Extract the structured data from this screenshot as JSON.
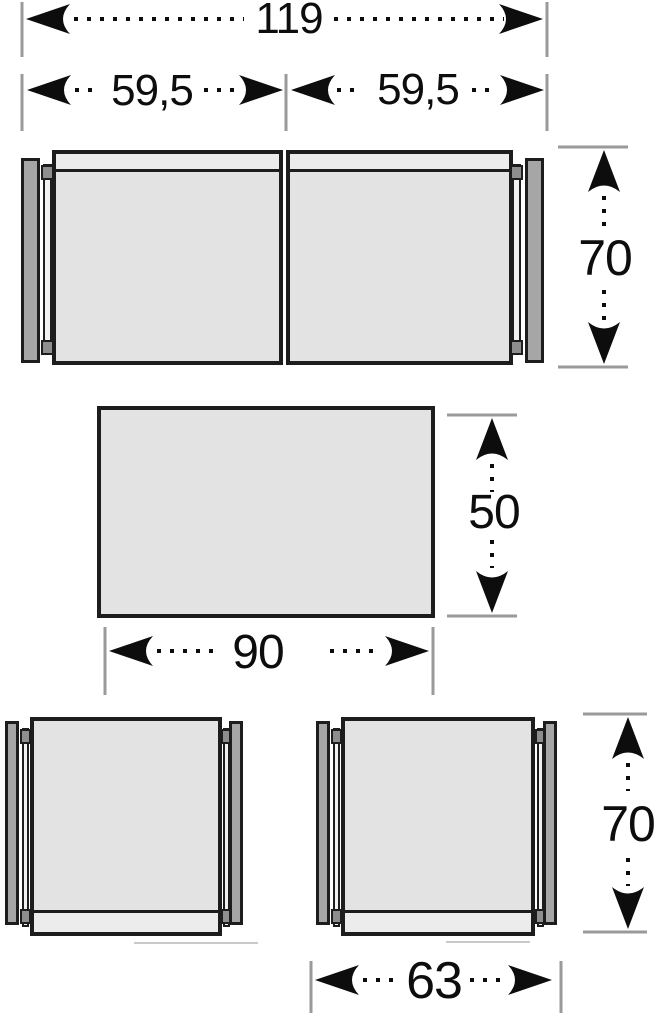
{
  "labels": {
    "sofa_total_width": "119",
    "sofa_left_seat_width": "59,5",
    "sofa_right_seat_width": "59,5",
    "sofa_depth": "70",
    "table_depth": "50",
    "table_width": "90",
    "chair_depth": "70",
    "chair_width": "63"
  },
  "colors": {
    "background": "#ffffff",
    "outline": "#1d1d1d",
    "seat_fill": "#e3e3e3",
    "backrest_fill": "#ececec",
    "armrest_fill": "#a6a6a6",
    "rail_fill": "#f1f1f1",
    "connector_fill": "#8e8e8e",
    "tick": "#9a9a9a",
    "dimension_text": "#0d0d0d",
    "shadow_line": "#c9c9c9"
  }
}
